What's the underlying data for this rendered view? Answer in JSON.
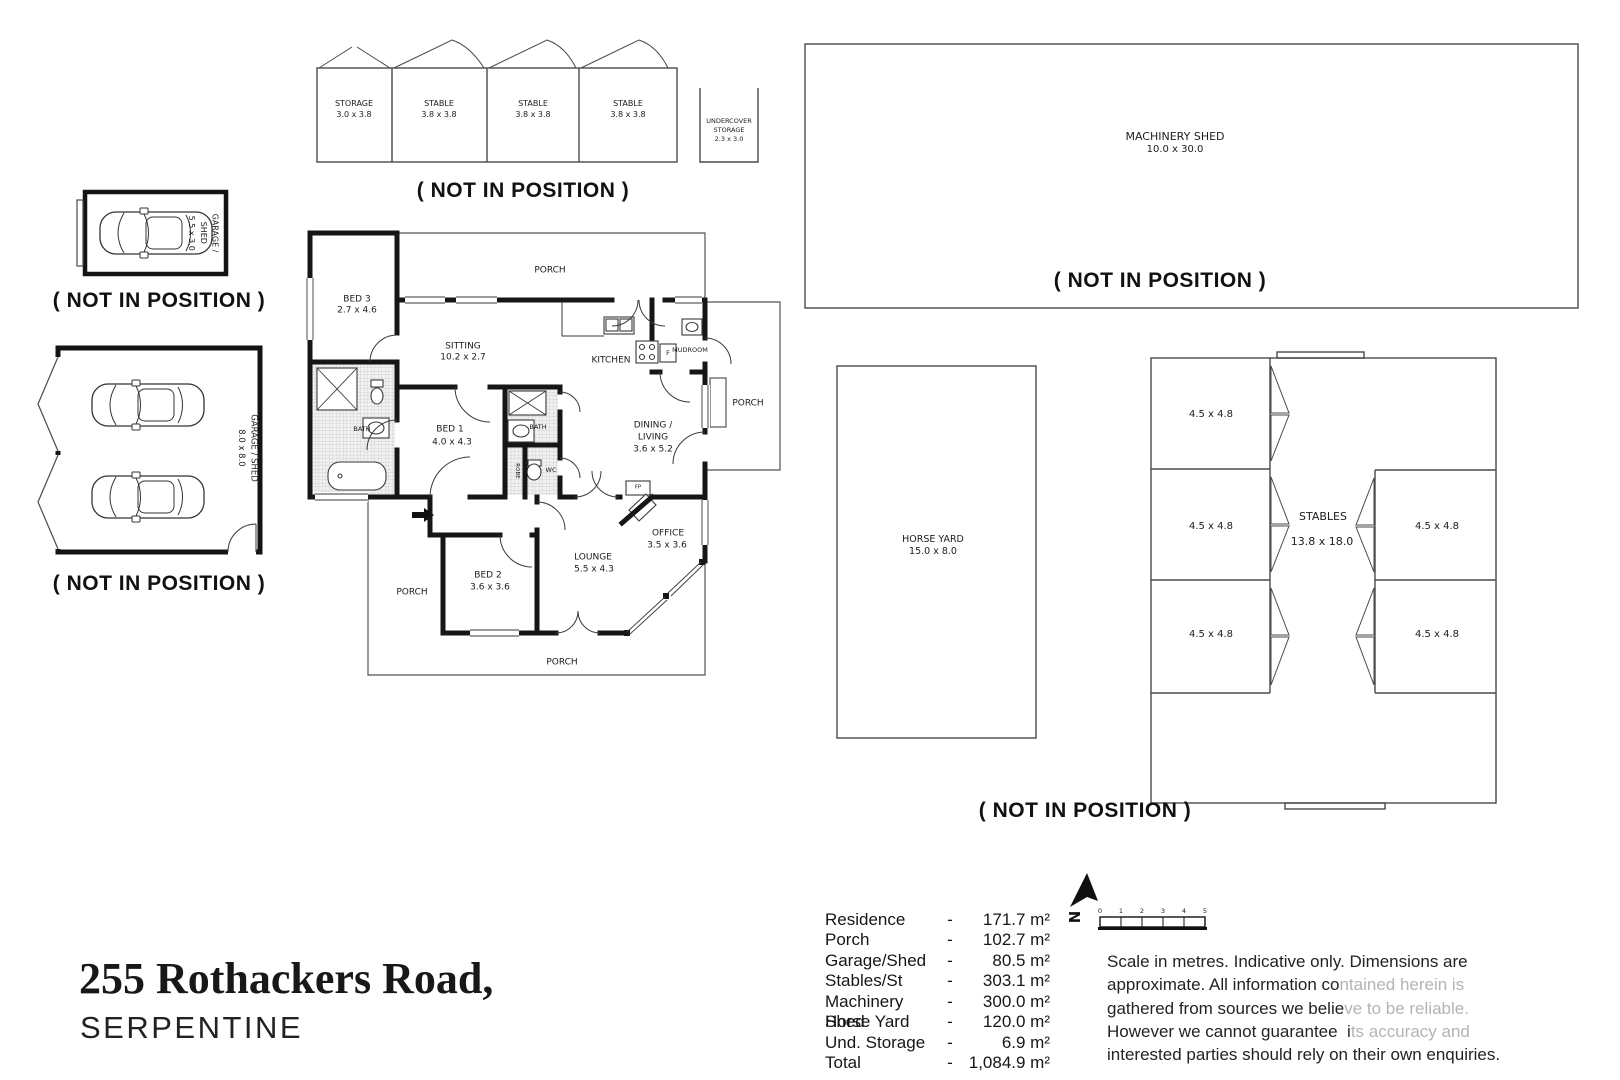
{
  "annotations": {
    "not_in_position": "( NOT IN POSITION )"
  },
  "title": {
    "address": "255 Rothackers Road,",
    "suburb": "SERPENTINE"
  },
  "stable_block": {
    "cells": [
      {
        "name": "STORAGE",
        "dims": "3.0 x 3.8"
      },
      {
        "name": "STABLE",
        "dims": "3.8 x 3.8"
      },
      {
        "name": "STABLE",
        "dims": "3.8 x 3.8"
      },
      {
        "name": "STABLE",
        "dims": "3.8 x 3.8"
      }
    ],
    "undercover": {
      "name_line1": "UNDERCOVER",
      "name_line2": "STORAGE",
      "dims": "2.3 x 3.0"
    }
  },
  "garage_small": {
    "label_line1": "GARAGE /",
    "label_line2": "SHED",
    "dims": "5.5 x 3.0"
  },
  "garage_large": {
    "label": "GARAGE / SHED",
    "dims": "8.0 x 8.0"
  },
  "machinery_shed": {
    "name": "MACHINERY SHED",
    "dims": "10.0 x 30.0"
  },
  "horse_yard": {
    "name": "HORSE YARD",
    "dims": "15.0 x 8.0"
  },
  "stables": {
    "name": "STABLES",
    "dims": "13.8 x 18.0",
    "stalls": [
      "4.5 x 4.8",
      "4.5 x 4.8",
      "4.5 x 4.8",
      "4.5 x 4.8",
      "4.5 x 4.8"
    ]
  },
  "house": {
    "rooms": [
      {
        "name": "BED 3",
        "dims": "2.7 x 4.6"
      },
      {
        "name": "SITTING",
        "dims": "10.2 x 2.7"
      },
      {
        "name": "BED 1",
        "dims": "4.0 x 4.3"
      },
      {
        "name": "DINING /",
        "name2": "LIVING",
        "dims": "3.6 x 5.2"
      },
      {
        "name": "OFFICE",
        "dims": "3.5 x 3.6"
      },
      {
        "name": "LOUNGE",
        "dims": "5.5 x 4.3"
      },
      {
        "name": "BED 2",
        "dims": "3.6 x 3.6"
      }
    ],
    "labels": {
      "porch": "PORCH",
      "kitchen": "KITCHEN",
      "mudroom": "MUDROOM",
      "bath": "BATH",
      "wc": "WC",
      "robe": "ROBE",
      "fp": "FP",
      "fridge": "F"
    }
  },
  "areas": {
    "separator": "-",
    "rows": [
      {
        "label": "Residence",
        "value": "171.7 m²"
      },
      {
        "label": "Porch",
        "value": "102.7 m²"
      },
      {
        "label": "Garage/Shed",
        "value": "80.5 m²"
      },
      {
        "label": "Stables/St",
        "value": "303.1 m²"
      },
      {
        "label": "Machinery Shed",
        "value": "300.0 m²"
      },
      {
        "label": "Horse Yard",
        "value": "120.0 m²"
      },
      {
        "label": "Und. Storage",
        "value": "6.9 m²"
      },
      {
        "label": "Total",
        "value": "1,084.9 m²"
      }
    ]
  },
  "compass": {
    "north": "N"
  },
  "scale_bar": {
    "ticks": [
      "0",
      "1",
      "2",
      "3",
      "4",
      "5"
    ]
  },
  "disclaimer": {
    "lines": [
      {
        "dark": "Scale in metres. Indicative only. Dimensions are",
        "light": ""
      },
      {
        "dark": "approximate. All information co",
        "light": "ntained herein is"
      },
      {
        "dark": "gathered from sources we belie",
        "light": "ve to be reliable."
      },
      {
        "dark": "However we cannot guarantee  i",
        "light": "ts accuracy and"
      },
      {
        "dark": "interested parties should rely on their own enquiries.",
        "light": ""
      }
    ]
  }
}
